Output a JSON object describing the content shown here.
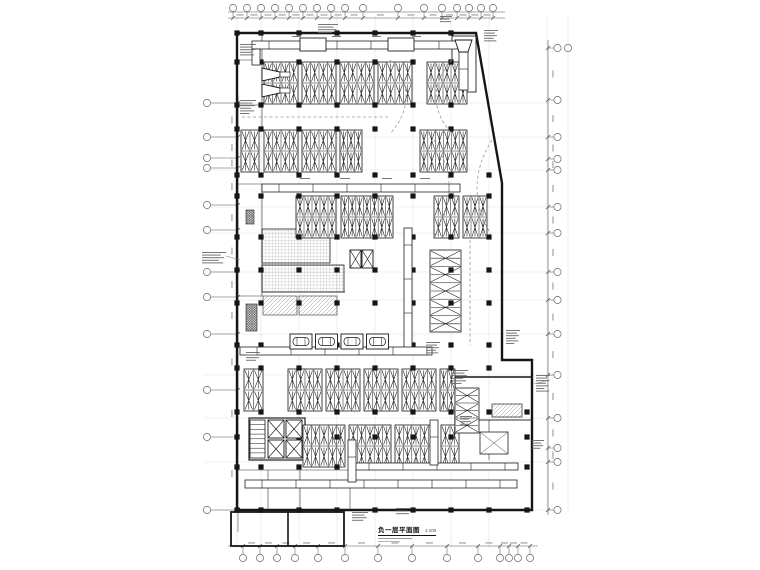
{
  "drawing": {
    "title": "负一层平面图",
    "scale": "1:100",
    "type_label": "地下车库平面 (CAD)",
    "colors": {
      "ink": "#161616",
      "dim": "#8a8a8a",
      "faint": "#b9b9b9",
      "background": "#ffffff"
    }
  }
}
